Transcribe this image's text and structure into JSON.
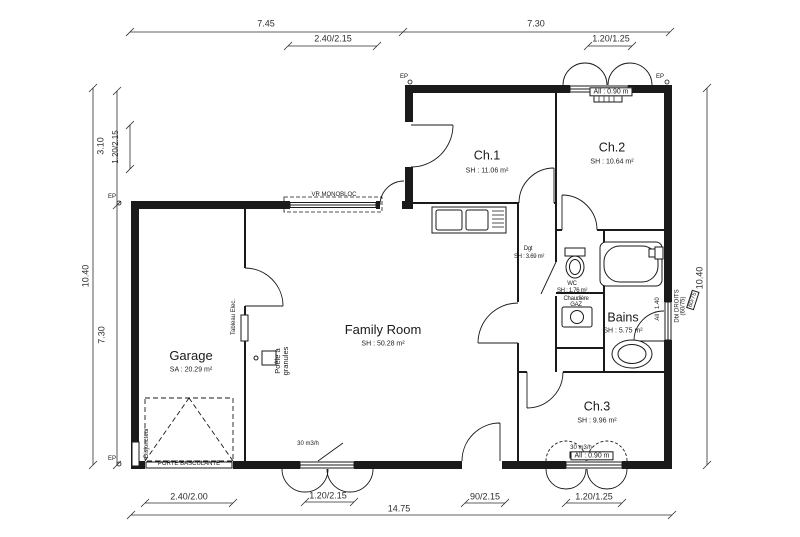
{
  "rooms": {
    "garage": {
      "name": "Garage",
      "area": "SA : 20.29 m²"
    },
    "family": {
      "name": "Family Room",
      "area": "SH : 50.28 m²"
    },
    "ch1": {
      "name": "Ch.1",
      "area": "SH : 11.06 m²"
    },
    "ch2": {
      "name": "Ch.2",
      "area": "SH : 10.64 m²"
    },
    "ch3": {
      "name": "Ch.3",
      "area": "SH : 9.96 m²"
    },
    "bains": {
      "name": "Bains",
      "area": "SH : 5.75 m²"
    },
    "dgt": {
      "name": "Dgt",
      "area": "SH : 3.69 m²"
    },
    "wc": {
      "name": "WC",
      "area": "SH : 1.76 m²"
    }
  },
  "dimensions": {
    "top_left_total": "7.45",
    "top_left_window": "2.40/2.15",
    "top_right_total": "7.30",
    "top_right_window": "1.20/1.25",
    "left_offset": "3.10",
    "left_window": "1.20/2.15",
    "left_total": "10.40",
    "left_wing": "7.30",
    "right_total": "10.40",
    "bottom_garage_door": "2.40/2.00",
    "bottom_family_window": "1.20/2.15",
    "bottom_entry_door": "90/2.15",
    "bottom_ch3_window": "1.20/1.25",
    "bottom_total": "14.75"
  },
  "annotations": {
    "vr_monobloc": "VR MONOBLOC",
    "porte_basculante": "PORTE BASCULANTE",
    "tableau_elec": "Tableau Elec.",
    "poele_line1": "Poêle à",
    "poele_line2": "granules",
    "chaudiere_line1": "Chaudière",
    "chaudiere_line2": "GAZ",
    "disjoncteur": "Disjoncteur",
    "sill_090": "All : 0.90 m",
    "sill_140": "All : 1.40",
    "droits_line1": "Dbl DROITS",
    "droits_line2": "(60/75)",
    "window_6075": "60/75",
    "airflow": "30 m3/h",
    "ep": "EP"
  },
  "colors": {
    "line": "#1a1a1a",
    "dim": "#2e2e2e",
    "background": "#ffffff"
  }
}
